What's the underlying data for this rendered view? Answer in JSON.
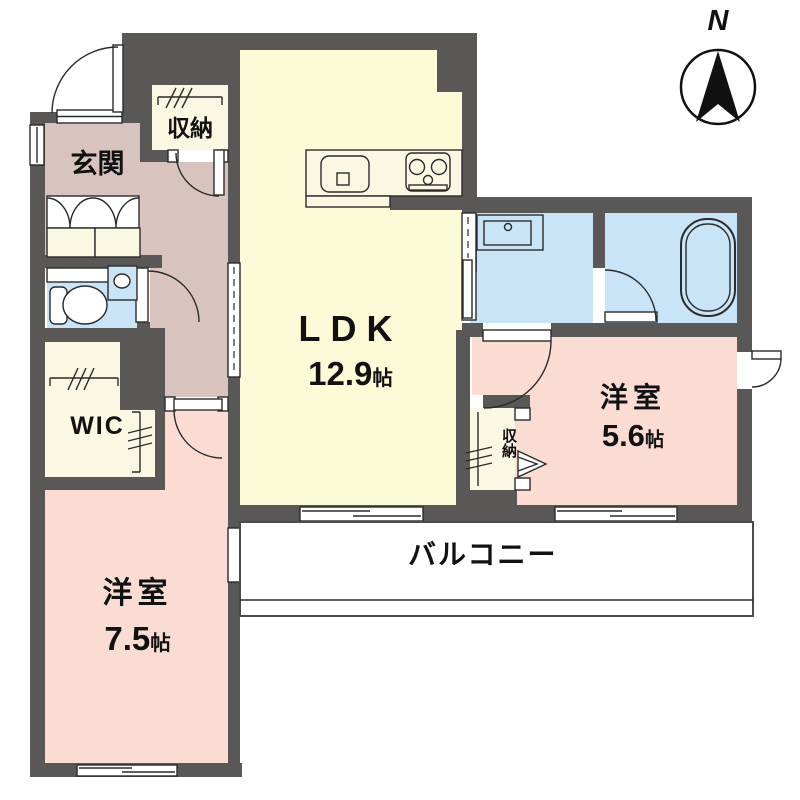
{
  "colors": {
    "wall": "#5a5757",
    "line": "#2b2b2b",
    "text": "#111111",
    "ldk": "#fbfbd8",
    "bedroom": "#fadcd3",
    "hall": "#d9c3be",
    "wet": "#c9e4f7",
    "closet": "#faf8e3",
    "balcony": "#ffffff",
    "compass": "#111111"
  },
  "compass": {
    "label": "N"
  },
  "rooms": {
    "ldk": {
      "label": "LDK",
      "area": "12.9",
      "unit": "帖"
    },
    "bedroom_main": {
      "label": "洋室",
      "area": "7.5",
      "unit": "帖"
    },
    "bedroom_second": {
      "label": "洋室",
      "area": "5.6",
      "unit": "帖"
    },
    "entrance": {
      "label": "玄関"
    },
    "entrance_closet": {
      "label": "収納"
    },
    "bedroom_closet": {
      "label": "収納"
    },
    "wic": {
      "label": "WIC"
    },
    "balcony": {
      "label": "バルコニー"
    }
  },
  "icons": {
    "kitchen_sink": "kitchen-sink",
    "gas_stove": "gas-stove",
    "toilet": "toilet",
    "hand_basin": "hand-basin",
    "washbasin": "washbasin",
    "bathtub": "bathtub",
    "hanger_pole": "hanger-pole",
    "north_arrow": "north-arrow"
  }
}
